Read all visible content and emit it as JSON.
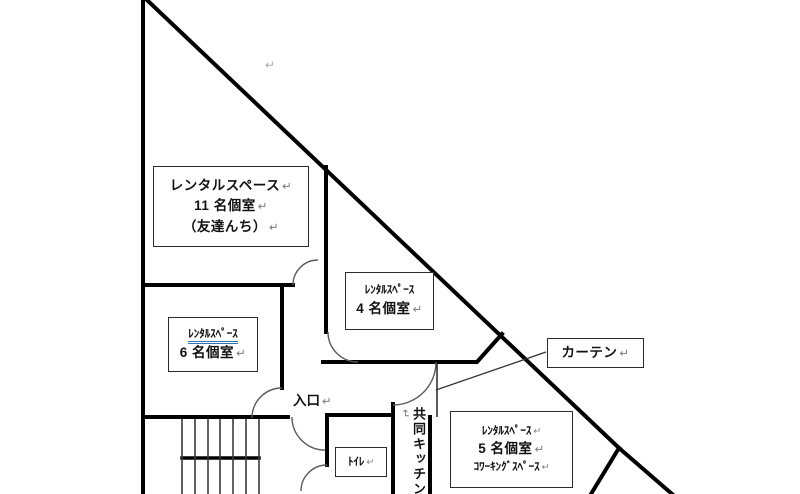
{
  "plan": {
    "rooms": {
      "room11": {
        "lines": [
          "レンタルスペース",
          "11 名個室",
          "（友達んち）"
        ]
      },
      "room4": {
        "lines": [
          "ﾚﾝﾀﾙｽﾍﾟｰｽ",
          "4 名個室"
        ]
      },
      "room6": {
        "lines": [
          "ﾚﾝﾀﾙｽﾍﾟｰｽ",
          "6 名個室"
        ]
      },
      "room5": {
        "lines": [
          "ﾚﾝﾀﾙｽﾍﾟｰｽ",
          "5 名個室",
          "ｺﾜｰｷﾝｸﾞｽﾍﾟｰｽ"
        ]
      },
      "toilet": {
        "label": "ﾄｲﾚ"
      },
      "kitchen": {
        "label": "共同キッチン"
      },
      "entrance": {
        "label": "入口"
      },
      "curtain": {
        "label": "カーテン"
      }
    },
    "marks": {
      "return": "↵"
    },
    "colors": {
      "wall": "#000000",
      "door_arc": "#5a5a5a",
      "stair_line": "#3a3a3a",
      "curtain_line": "#333333",
      "spellcheck_underline": "#2e74b5",
      "format_mark": "#8c8c8c"
    }
  }
}
